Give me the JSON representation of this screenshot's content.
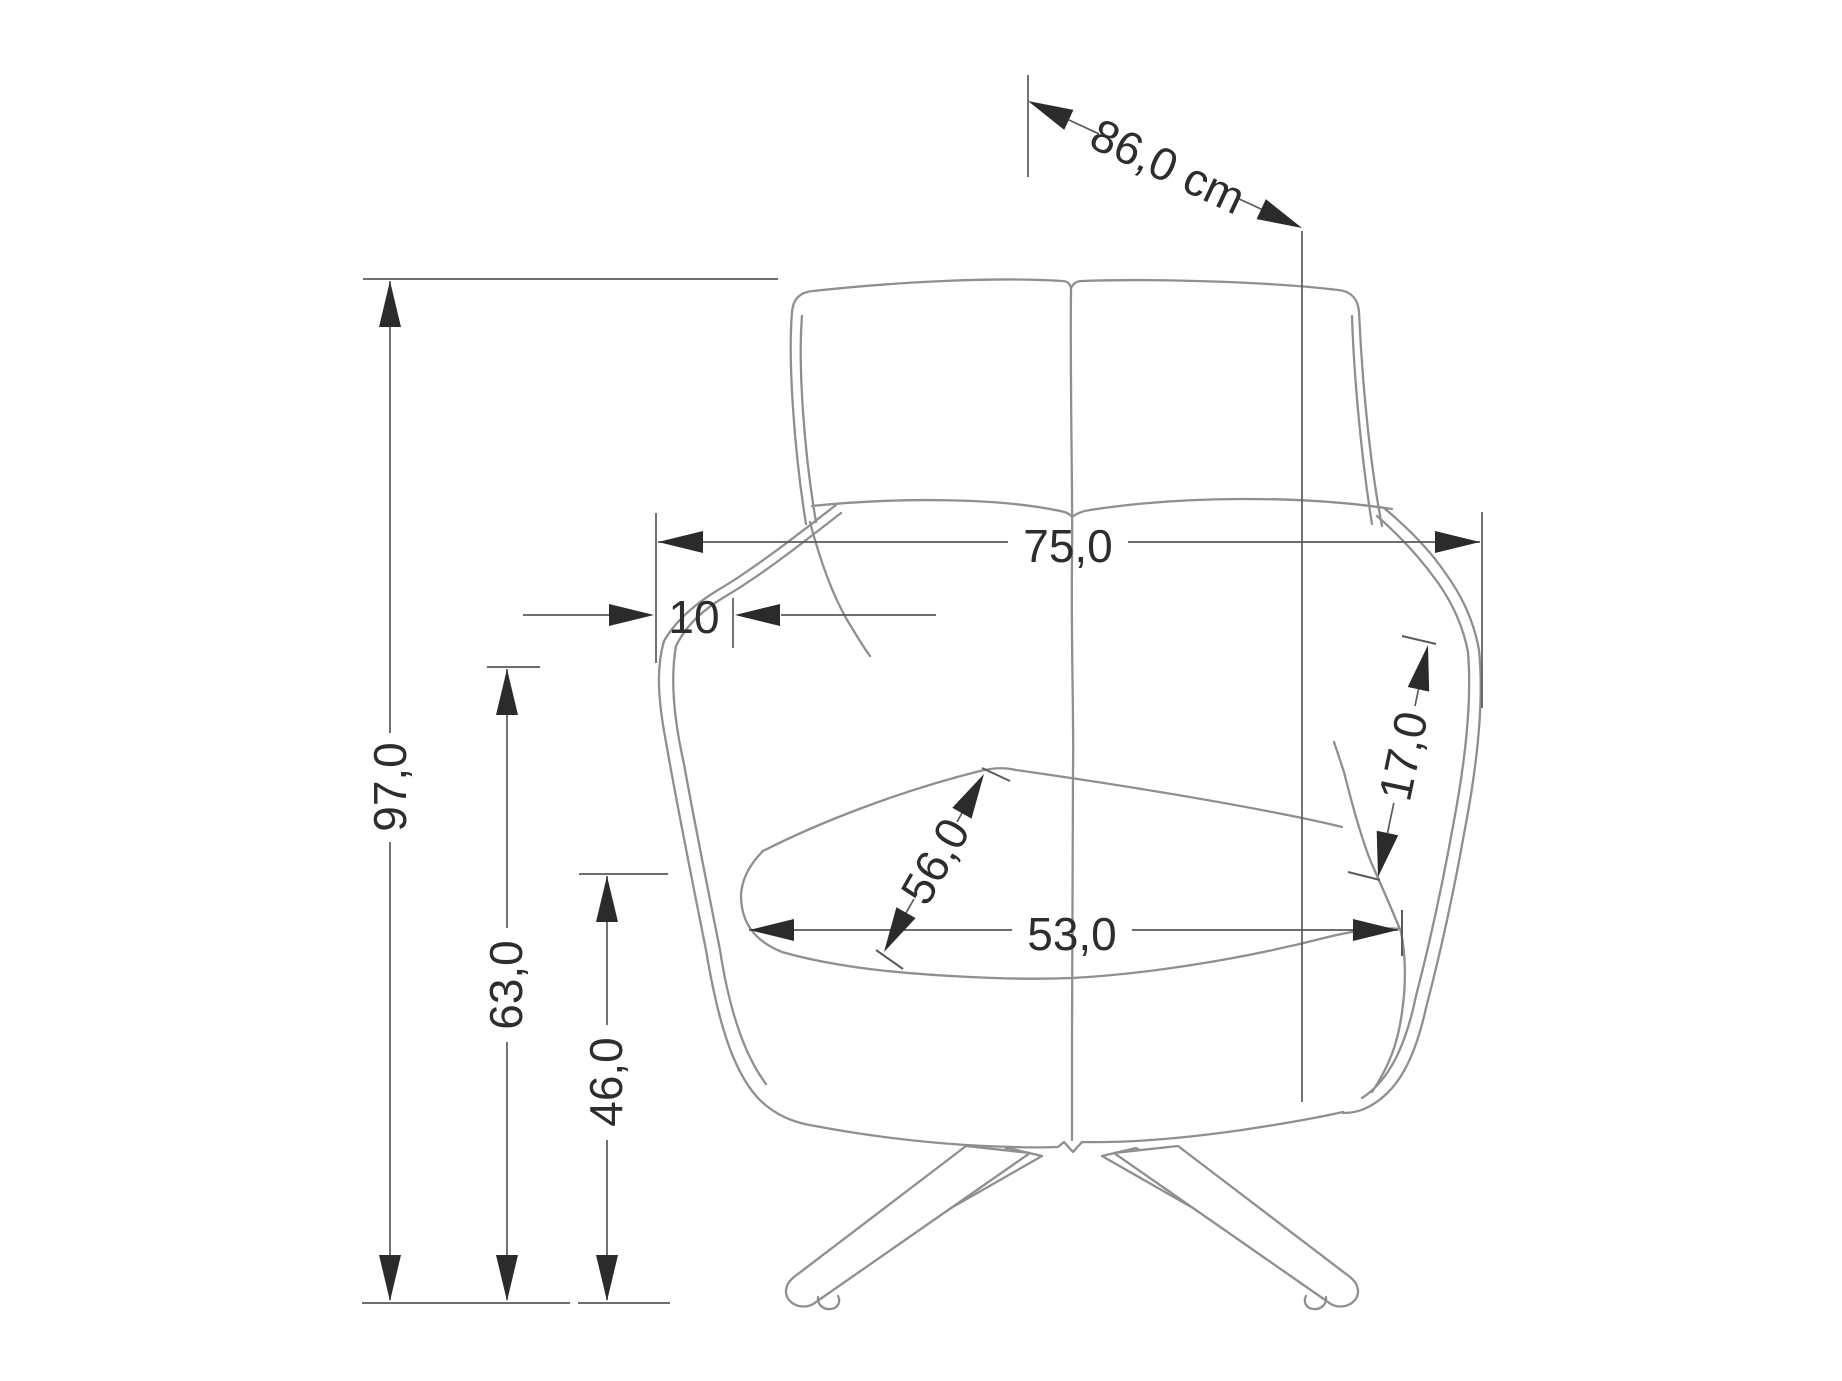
{
  "drawing": {
    "title": "Armchair front-view dimension drawing",
    "labels": {
      "depth": "86,0 cm",
      "height_total": "97,0",
      "armrest_height": "63,0",
      "seat_height": "46,0",
      "width_total": "75,0",
      "arm_top_width": "10",
      "seat_depth": "56,0",
      "wing_length": "17,0",
      "seat_width": "53,0"
    },
    "colors": {
      "background": "#ffffff",
      "chair_line": "#8f8f8f",
      "dimension_line": "#5a5a5a",
      "arrow_fill": "#2b2b2b",
      "text": "#2d2d2d"
    }
  }
}
